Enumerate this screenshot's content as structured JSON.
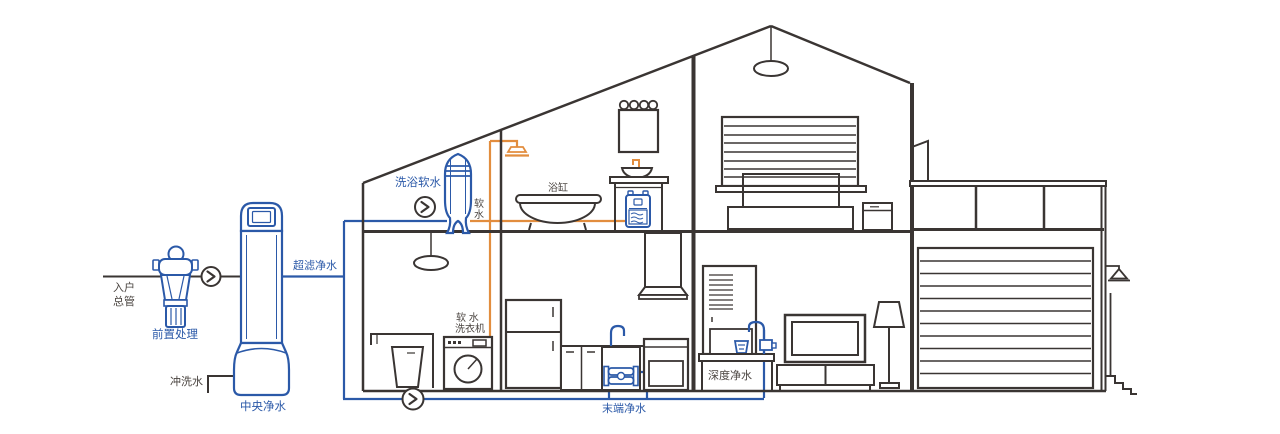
{
  "diagram": {
    "description_type": "whole-house water purification cutaway diagram",
    "colors": {
      "outline_dark": "#3a3533",
      "pipe_purified_blue": "#2b59a8",
      "pipe_soft_orange": "#e28d3e",
      "label_blue": "#2b59a8",
      "label_dark": "#4a4440",
      "background": "#ffffff"
    },
    "icons": {
      "flow_indicator": "chevron-right-in-circle",
      "ceiling_lamp": "pendant-lamp",
      "wall_lamp": "triangle-wall-lamp"
    },
    "labels": {
      "inlet_main": {
        "line1": "入户",
        "line2": "总管"
      },
      "pre_treatment": "前置处理",
      "flush_water": "冲洗水",
      "central_purifier": "中央净水",
      "ultra_filtration": "超滤净水",
      "shower_softener": "洗浴软水",
      "soft_water": {
        "char1": "软",
        "char2": "水"
      },
      "bathtub": "浴缸",
      "soft_water_washer": {
        "line1": "软 水",
        "line2": "洗衣机"
      },
      "terminal_purifier": "末端净水",
      "deep_purifier": "深度净水"
    }
  }
}
